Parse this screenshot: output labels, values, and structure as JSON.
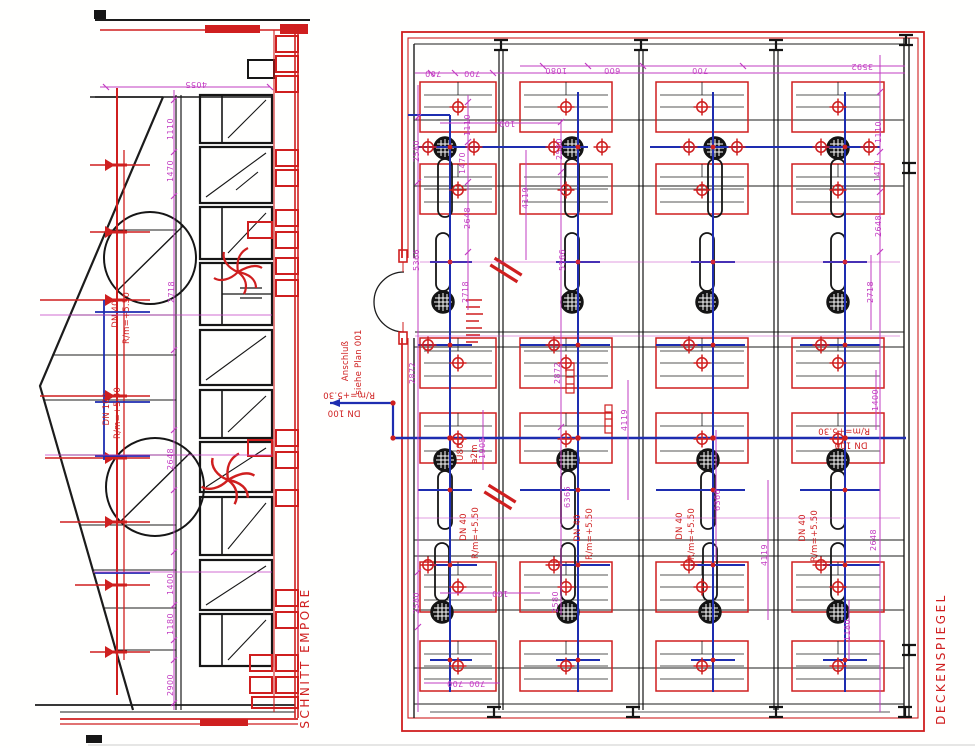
{
  "drawing": {
    "left": {
      "title": "SCHNITT EMPORE"
    },
    "right": {
      "title": "DECKENSPIEGEL"
    },
    "labels": {
      "anschluss": "Anschluß",
      "siehe_plan": "siehe Plan 001",
      "dn40": "DN 40",
      "dn100": "DN 100",
      "r530": "R/m=+5.30",
      "r550": "R/m=+5.50",
      "u80": "U80",
      "a2m": "a2m"
    },
    "dims": {
      "d100": "100",
      "d600": "600",
      "d700": "700",
      "d1080": "1080",
      "d1110": "1110",
      "d1180": "1180",
      "d1400": "1400",
      "d1470": "1470",
      "d1905": "1905",
      "d2580": "2580",
      "d2648": "2648",
      "d2718": "2718",
      "d2872": "2872",
      "d2900": "2900",
      "d3592": "3592",
      "d4055": "4055",
      "d4119": "4119",
      "d5366": "5366",
      "d6366": "6366"
    },
    "colors": {
      "line_black": "#1c1c1c",
      "sprinkler_red": "#cf1f1f",
      "dimension_magenta": "#c23cc2",
      "pipe_blue": "#1e2db0",
      "paper": "#ffffff"
    }
  }
}
